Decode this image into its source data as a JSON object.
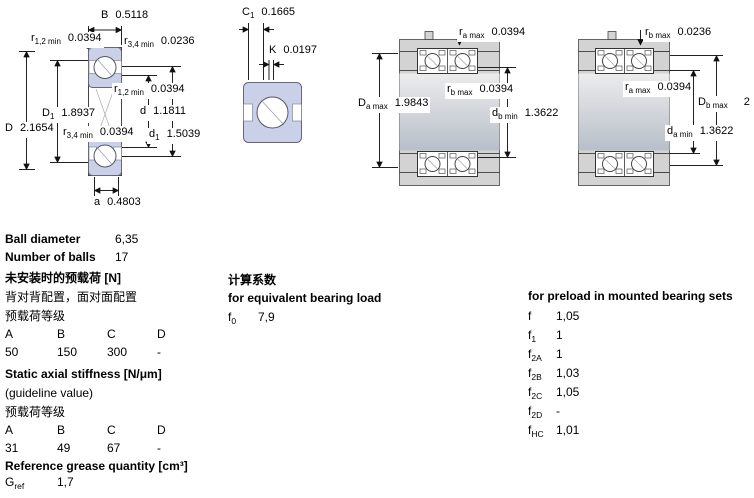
{
  "dims": {
    "d1_B": {
      "base": "B",
      "sub": "",
      "value": "0.5118"
    },
    "d1_r12_top": {
      "base": "r",
      "sub": "1,2 min",
      "value": "0.0394"
    },
    "d1_r34_top": {
      "base": "r",
      "sub": "3,4 min",
      "value": "0.0236"
    },
    "d1_r12_mid": {
      "base": "r",
      "sub": "1,2 min",
      "value": "0.0394"
    },
    "d1_D1": {
      "base": "D",
      "sub": "1",
      "value": "1.8937"
    },
    "d1_d": {
      "base": "d",
      "sub": "",
      "value": "1.1811"
    },
    "d1_D": {
      "base": "D",
      "sub": "",
      "value": "2.1654"
    },
    "d1_r34_mid": {
      "base": "r",
      "sub": "3,4 min",
      "value": "0.0394"
    },
    "d1_d1": {
      "base": "d",
      "sub": "1",
      "value": "1.5039"
    },
    "d1_a": {
      "base": "a",
      "sub": "",
      "value": "0.4803"
    },
    "d2_C1": {
      "base": "C",
      "sub": "1",
      "value": "0.1665"
    },
    "d2_K": {
      "base": "K",
      "sub": "",
      "value": "0.0197"
    },
    "d3_ra": {
      "base": "r",
      "sub": "a max",
      "value": "0.0394"
    },
    "d3_rb": {
      "base": "r",
      "sub": "b max",
      "value": "0.0394"
    },
    "d3_Da": {
      "base": "D",
      "sub": "a max",
      "value": "1.9843"
    },
    "d3_db": {
      "base": "d",
      "sub": "b min",
      "value": "1.3622"
    },
    "d4_rb": {
      "base": "r",
      "sub": "b max",
      "value": "0.0236"
    },
    "d4_ra": {
      "base": "r",
      "sub": "a max",
      "value": "0.0394"
    },
    "d4_Db": {
      "base": "D",
      "sub": "b max",
      "value": "2"
    },
    "d4_da": {
      "base": "d",
      "sub": "a min",
      "value": "1.3622"
    }
  },
  "specs": {
    "ball_diameter_label": "Ball diameter",
    "ball_diameter_value": "6,35",
    "number_of_balls_label": "Number of balls",
    "number_of_balls_value": "17",
    "preload_unmounted_title": "未安装时的预载荷 [N]",
    "preload_config_note": "背对背配置，面对面配置",
    "preload_class_label": "预载荷等级",
    "class_headers": [
      "A",
      "B",
      "C",
      "D"
    ],
    "preload_values": [
      "50",
      "150",
      "300",
      "-"
    ],
    "stiffness_title": "Static axial stiffness [N/μm]",
    "stiffness_note": "(guideline value)",
    "stiffness_class_label": "预载荷等级",
    "stiffness_values": [
      "31",
      "49",
      "67",
      "-"
    ],
    "grease_title": "Reference grease quantity [cm³]",
    "grease_ref": {
      "base": "G",
      "sub": "ref",
      "value": "1,7"
    }
  },
  "factors": {
    "calc_title_zh": "计算系数",
    "equivalent_title": "for equivalent bearing load",
    "f0": {
      "base": "f",
      "sub": "0",
      "value": "7,9"
    },
    "preload_title": "for preload in mounted bearing sets",
    "rows": [
      {
        "base": "f",
        "sub": "",
        "value": "1,05"
      },
      {
        "base": "f",
        "sub": "1",
        "value": "1"
      },
      {
        "base": "f",
        "sub": "2A",
        "value": "1"
      },
      {
        "base": "f",
        "sub": "2B",
        "value": "1,03"
      },
      {
        "base": "f",
        "sub": "2C",
        "value": "1,05"
      },
      {
        "base": "f",
        "sub": "2D",
        "value": "-"
      },
      {
        "base": "f",
        "sub": "HC",
        "value": "1,01"
      }
    ]
  },
  "colors": {
    "bearing_fill": "#c9d0e8",
    "housing_fill": "#d3d3d3",
    "line": "#222222"
  }
}
